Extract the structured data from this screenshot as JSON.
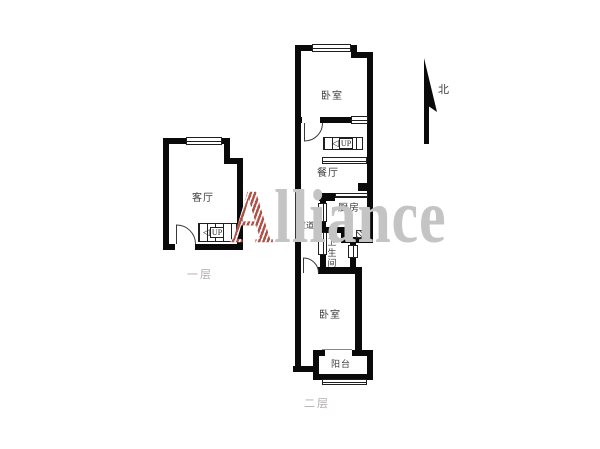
{
  "compass": {
    "label": "北"
  },
  "watermark": {
    "lead": "A",
    "rest": "lliance"
  },
  "floors": [
    {
      "caption": "一层",
      "rooms": {
        "living_room": "客厅"
      },
      "stairs": {
        "arrow": "◁",
        "label": "UP"
      }
    },
    {
      "caption": "二层",
      "rooms": {
        "bedroom_north": "卧室",
        "dining_room": "餐厅",
        "kitchen": "厨房",
        "hallway": "过道",
        "bathroom": "卫生间",
        "bedroom_south": "卧室",
        "balcony": "阳台"
      },
      "stairs": {
        "arrow": "◁",
        "label": "UP"
      }
    }
  ]
}
